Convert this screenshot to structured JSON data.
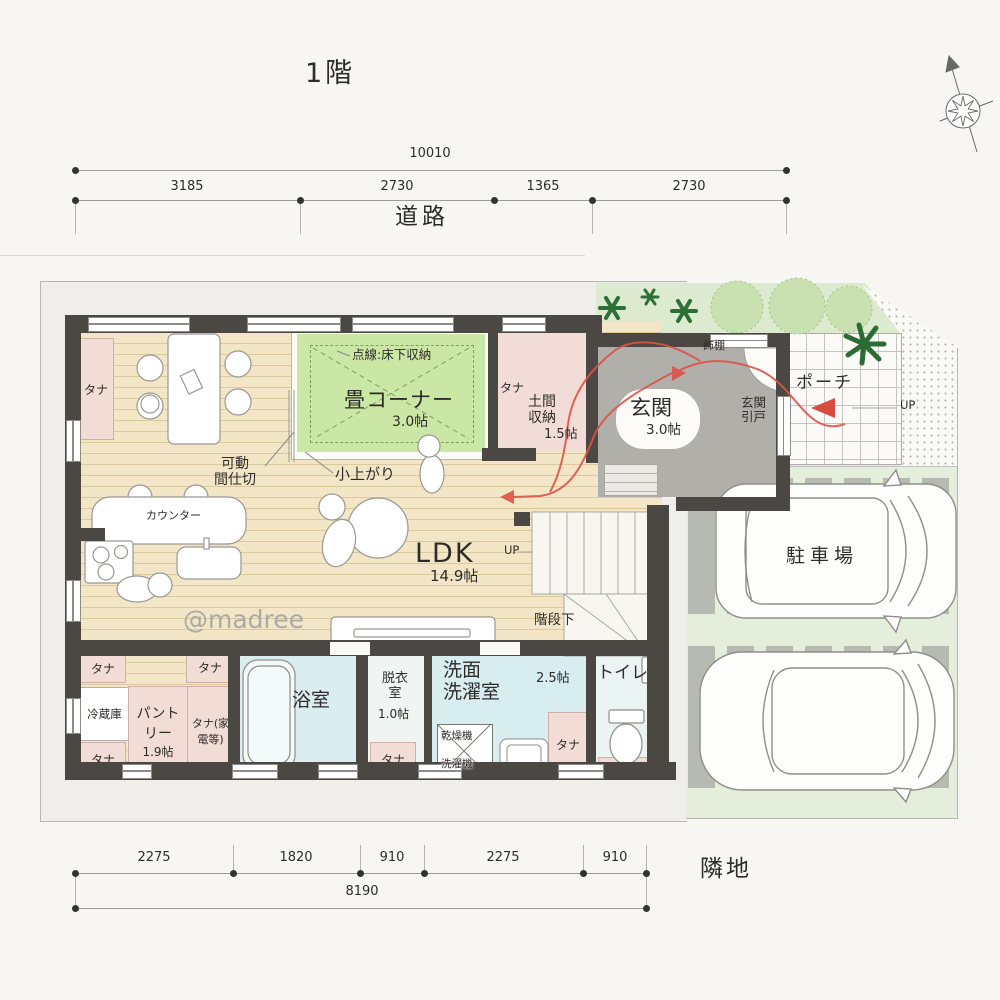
{
  "page": {
    "title": "1階",
    "watermark": "@madree",
    "road": "道路",
    "neighbor": "隣地",
    "up": "UP"
  },
  "dims": {
    "top": {
      "total": "10010",
      "segments": [
        "3185",
        "2730",
        "1365",
        "2730"
      ]
    },
    "bottom": {
      "total": "8190",
      "segments": [
        "2275",
        "1820",
        "910",
        "2275",
        "910"
      ]
    }
  },
  "rooms": {
    "shelf": "タナ",
    "tatami": {
      "name": "畳コーナー",
      "size": "3.0帖",
      "note": "点線:床下収納",
      "step": "小上がり"
    },
    "doma": {
      "l1": "土間",
      "l2": "収納",
      "size": "1.5帖"
    },
    "genkan": {
      "name": "玄関",
      "size": "3.0帖",
      "door_l1": "玄関",
      "door_l2": "引戸",
      "shelf": "飾棚"
    },
    "porch": {
      "name": "ポーチ"
    },
    "ldk": {
      "name": "LDK",
      "size": "14.9帖",
      "counter": "カウンター",
      "partition_l1": "可動",
      "partition_l2": "間仕切",
      "under_stairs": "階段下"
    },
    "bath": {
      "name": "浴室"
    },
    "dressing": {
      "l1": "脱衣",
      "l2": "室",
      "size": "1.0帖"
    },
    "laundry": {
      "l1": "洗面",
      "l2": "洗濯室",
      "size": "2.5帖",
      "dryer": "乾燥機",
      "washer": "洗濯機"
    },
    "toilet": {
      "name": "トイレ"
    },
    "pantry": {
      "name": "パントリー",
      "size": "1.9帖",
      "fridge": "冷蔵庫",
      "appliance_shelf": "タナ(家電等)"
    },
    "parking": {
      "name": "駐車場"
    }
  }
}
